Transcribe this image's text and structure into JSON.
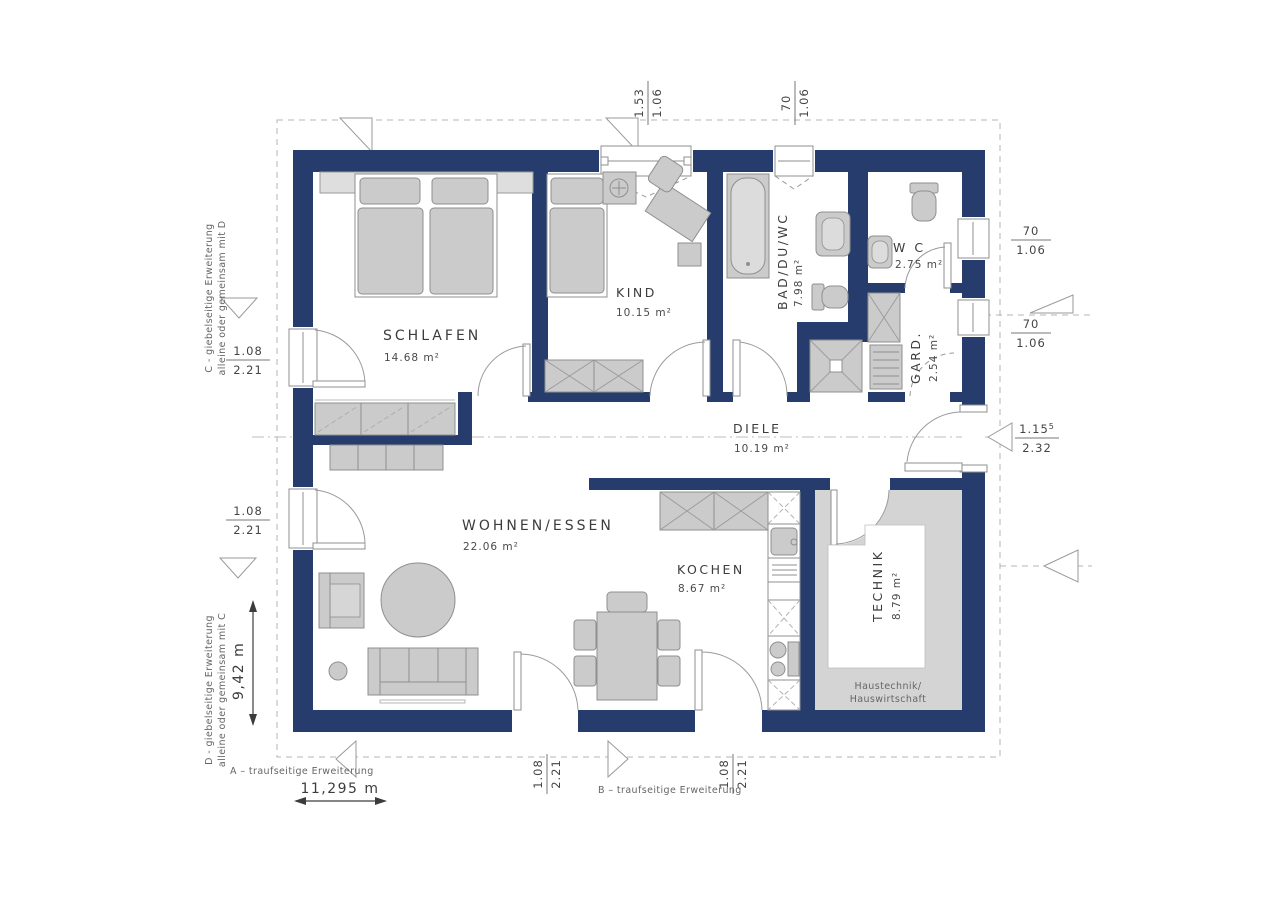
{
  "plan": {
    "rooms": [
      {
        "name": "SCHLAFEN",
        "area": "14.68 m²"
      },
      {
        "name": "KIND",
        "area": "10.15 m²"
      },
      {
        "name": "BAD/DU/WC",
        "area": "7.98 m²"
      },
      {
        "name": "W C",
        "area": "2.75 m²"
      },
      {
        "name": "GARD.",
        "area": "2.54 m²"
      },
      {
        "name": "DIELE",
        "area": "10.19 m²"
      },
      {
        "name": "WOHNEN/ESSEN",
        "area": "22.06 m²"
      },
      {
        "name": "KOCHEN",
        "area": "8.67 m²"
      },
      {
        "name": "TECHNIK",
        "area": "8.79 m²",
        "note_line1": "Haustechnik/",
        "note_line2": "Hauswirtschaft"
      }
    ],
    "dimensions": {
      "top": [
        {
          "num": "1.53",
          "den": "1.06"
        },
        {
          "num": "70",
          "den": "1.06"
        }
      ],
      "right": [
        {
          "num": "70",
          "den": "1.06"
        },
        {
          "num": "70",
          "den": "1.06"
        },
        {
          "num": "1.15",
          "sup": "5",
          "den": "2.32"
        }
      ],
      "left": [
        {
          "num": "1.08",
          "den": "2.21"
        },
        {
          "num": "1.08",
          "den": "2.21"
        }
      ],
      "bottom": [
        {
          "num": "1.08",
          "den": "2.21"
        },
        {
          "num": "1.08",
          "den": "2.21"
        }
      ]
    },
    "annotations": {
      "left_top_line1": "C - giebelseitige Erweiterung",
      "left_top_line2": "alleine oder gemeinsam mit D",
      "left_bottom_line1": "D - giebelseitige Erweiterung",
      "left_bottom_line2": "alleine oder gemeinsam mit C",
      "bottom_a": "A – traufseitige Erweiterung",
      "bottom_b": "B – traufseitige Erweiterung",
      "width_label": "11,295 m",
      "height_label": "9,42 m"
    },
    "colors": {
      "wall": "#253C6D",
      "furniture": "#CBCBCB",
      "floor_gray": "#D4D4D4",
      "line": "#8F8F8F",
      "text": "#3C3C3C",
      "dash": "#B4B4B4"
    }
  }
}
